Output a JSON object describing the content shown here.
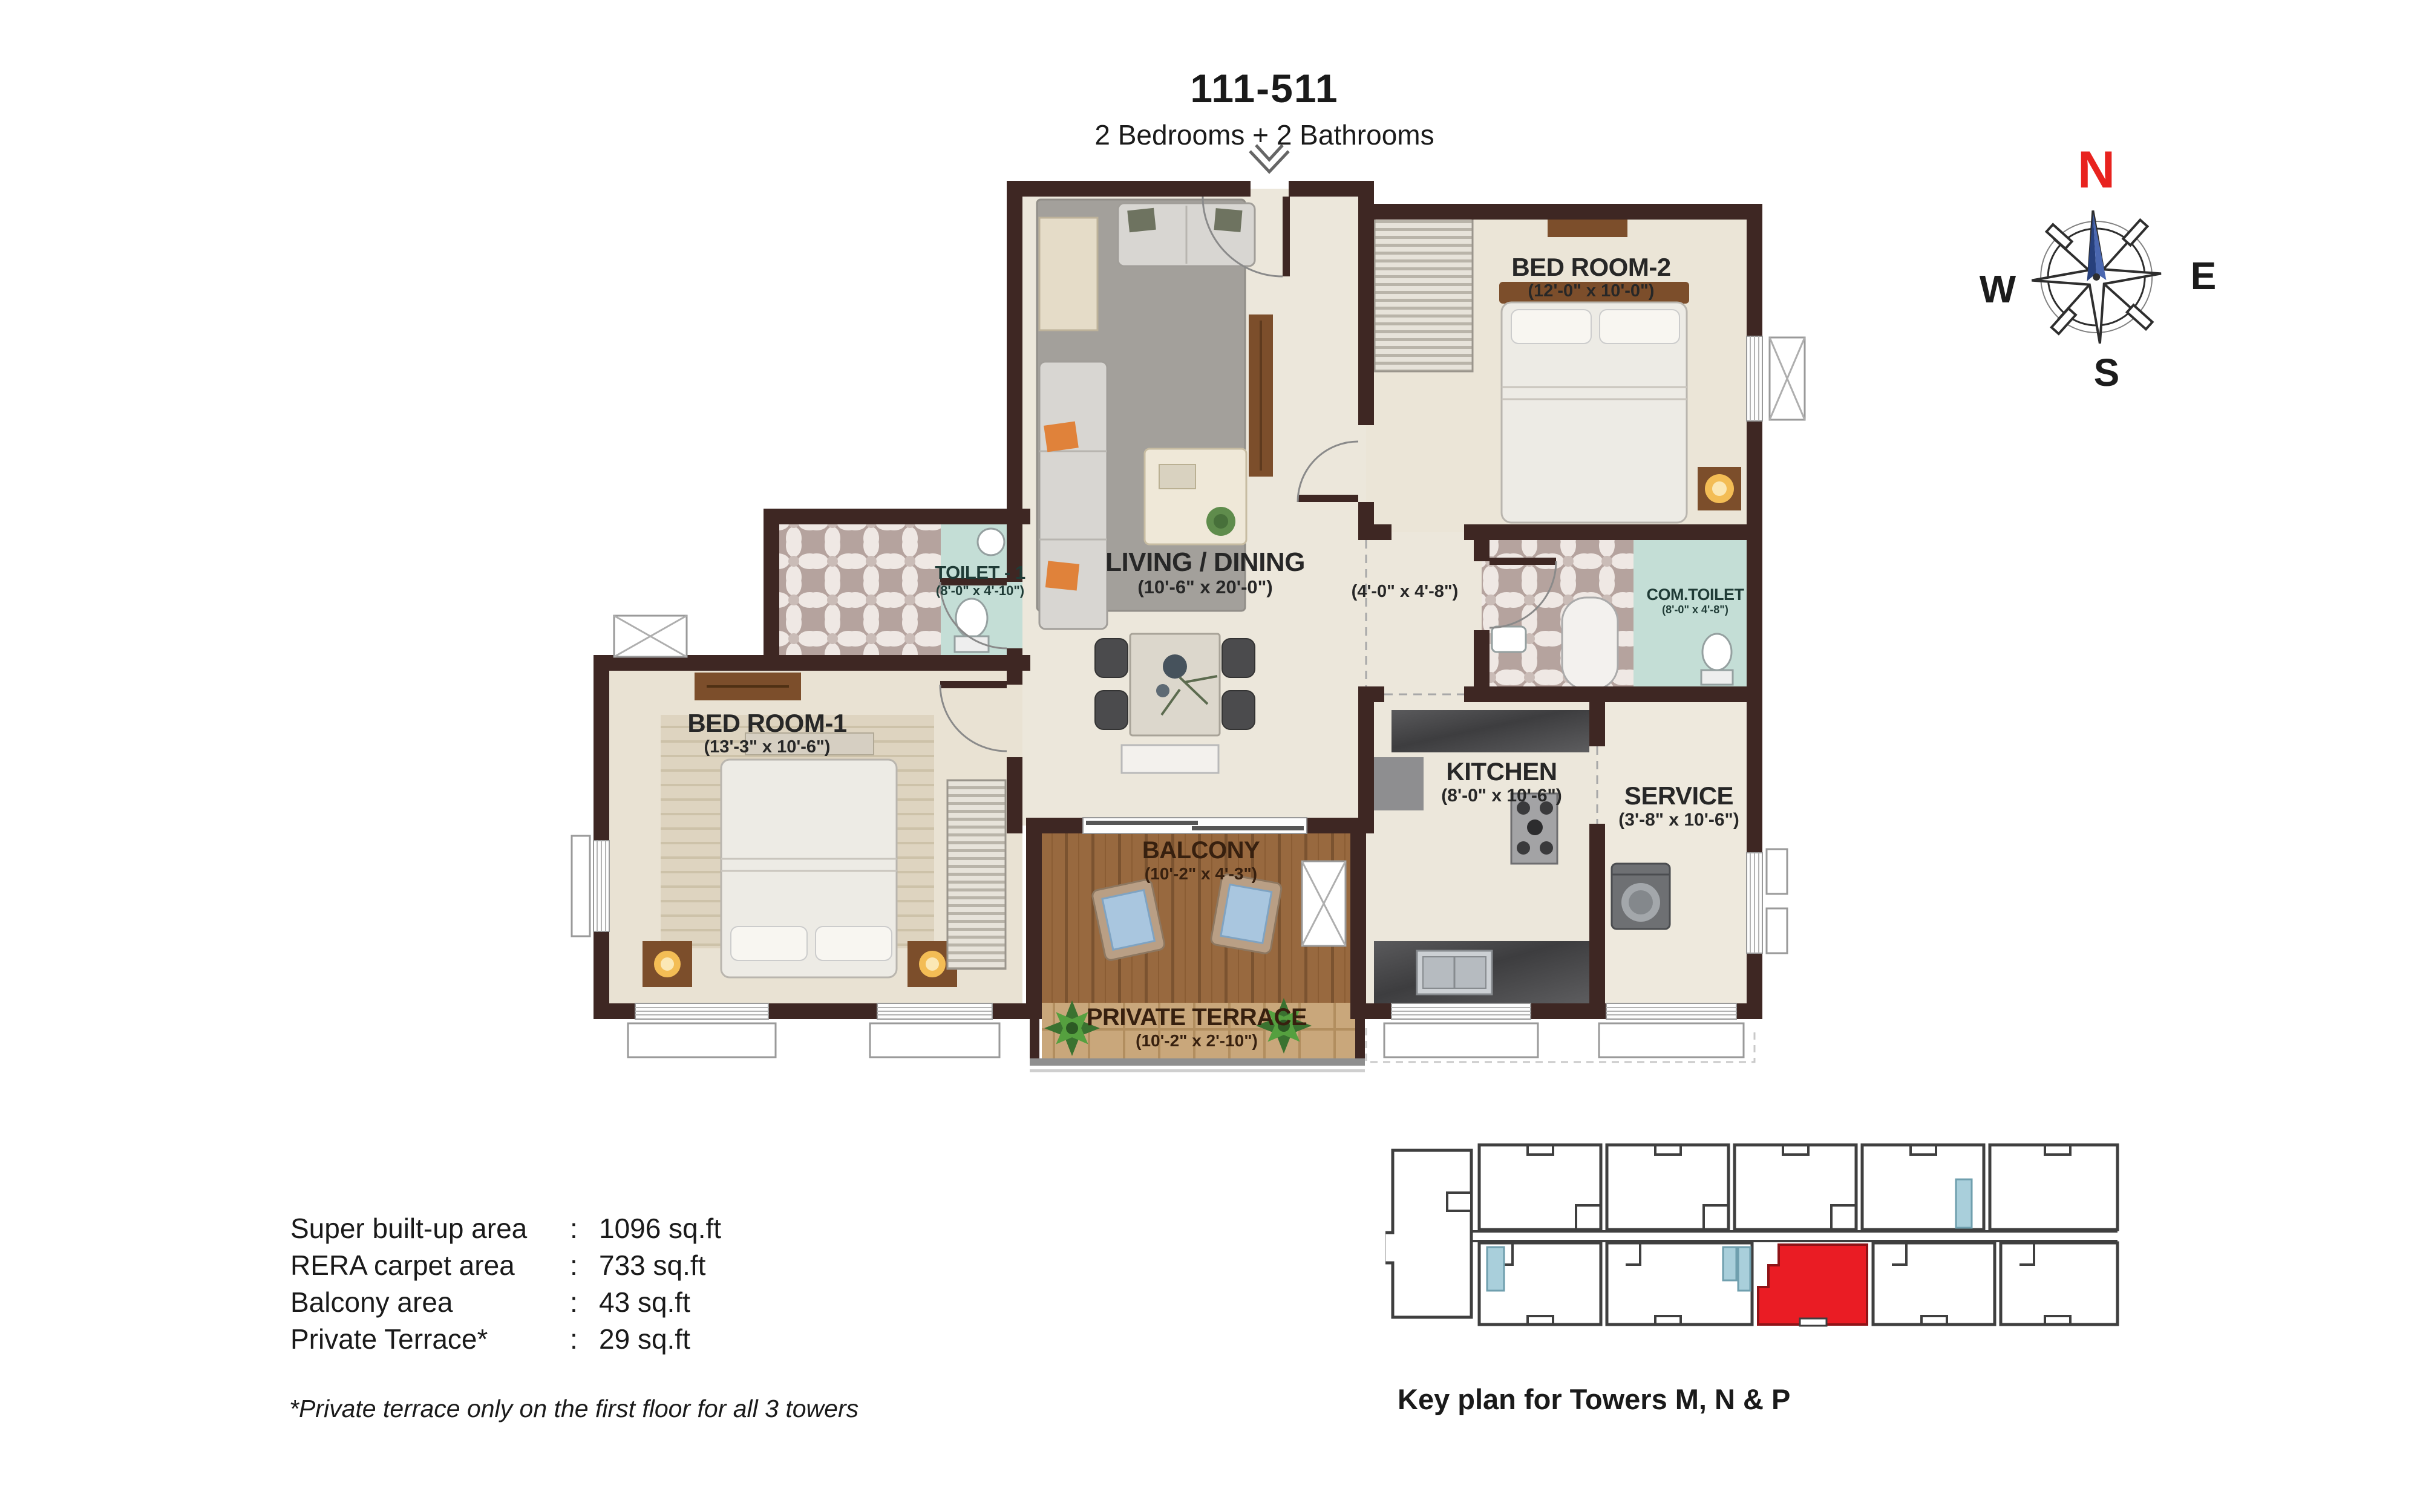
{
  "header": {
    "unit_id": "111-511",
    "configuration": "2 Bedrooms + 2 Bathrooms"
  },
  "compass": {
    "n": "N",
    "e": "E",
    "s": "S",
    "w": "W"
  },
  "rooms": {
    "living": {
      "name": "LIVING / DINING",
      "dims": "(10'-6\" x 20'-0\")"
    },
    "bedroom2": {
      "name": "BED ROOM-2",
      "dims": "(12'-0\" x 10'-0\")"
    },
    "toilet1": {
      "name": "TOILET - 1",
      "dims": "(8'-0\" x 4'-10\")"
    },
    "passage": {
      "dims": "(4'-0\" x 4'-8\")"
    },
    "com_toilet": {
      "name": "COM.TOILET",
      "dims": "(8'-0\" x 4'-8\")"
    },
    "bedroom1": {
      "name": "BED ROOM-1",
      "dims": "(13'-3\" x 10'-6\")"
    },
    "kitchen": {
      "name": "KITCHEN",
      "dims": "(8'-0\" x 10'-6\")"
    },
    "service": {
      "name": "SERVICE",
      "dims": "(3'-8\" x 10'-6\")"
    },
    "balcony": {
      "name": "BALCONY",
      "dims": "(10'-2\" x 4'-3\")"
    },
    "terrace": {
      "name": "PRIVATE TERRACE",
      "dims": "(10'-2\" x 2'-10\")"
    }
  },
  "area_table": {
    "rows": [
      {
        "label": "Super built-up area",
        "separator": ":",
        "value": "1096 sq.ft"
      },
      {
        "label": "RERA carpet area",
        "separator": ":",
        "value": "733 sq.ft"
      },
      {
        "label": "Balcony area",
        "separator": ":",
        "value": "43 sq.ft"
      },
      {
        "label": "Private Terrace*",
        "separator": ":",
        "value": "29 sq.ft"
      }
    ]
  },
  "footnote": "*Private terrace only on the first floor for all 3 towers",
  "key_plan": {
    "caption": "Key plan for Towers M, N & P"
  },
  "colors": {
    "wall": "#3e2723",
    "north_red": "#e8231f",
    "needle_blue": "#3c5ca8",
    "bath_teal": "#c4ded6",
    "mosaic_mauve": "#b5a39e",
    "balcony_wood": "#98693f",
    "terrace_wood": "#c9a77b",
    "keyplan_highlight": "#ea1c24",
    "keyplan_core_blue": "#a9cfdb"
  }
}
